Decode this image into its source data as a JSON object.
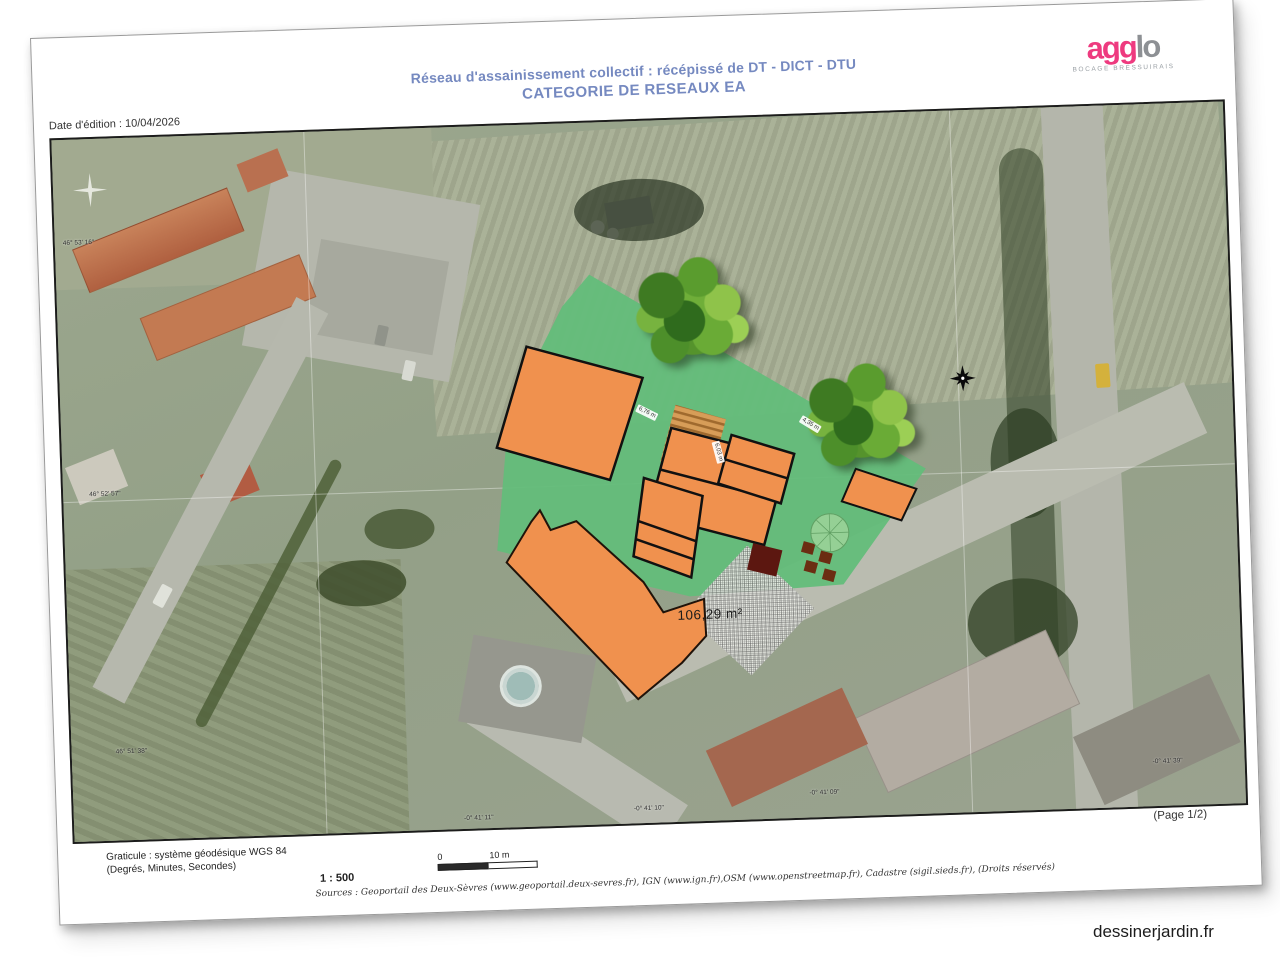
{
  "document": {
    "title_line1": "Réseau d'assainissement collectif : récépissé de DT - DICT - DTU",
    "title_line2": "CATEGORIE DE RESEAUX EA",
    "edition_date": "Date d'édition : 10/04/2026",
    "page_label": "(Page 1/2)"
  },
  "logo": {
    "text_pink": "agg",
    "text_gray": "lo",
    "subtitle": "BOCAGE BRESSUIRAIS"
  },
  "map": {
    "area_label": "106,29 m²",
    "dimension_labels": [
      {
        "text": "6,76 m"
      },
      {
        "text": "6,03 m"
      },
      {
        "text": "4,35 m"
      }
    ],
    "coordinate_labels": [
      {
        "text": "46° 53' 16\""
      },
      {
        "text": "46° 52' 57\""
      },
      {
        "text": "46° 51' 38\""
      },
      {
        "text": "-0° 41' 11\""
      },
      {
        "text": "-0° 41' 10\""
      },
      {
        "text": "-0° 41' 09\""
      },
      {
        "text": "-0° 41' 39\""
      }
    ]
  },
  "footer": {
    "graticule_line1": "Graticule : système géodésique WGS 84",
    "graticule_line2": "(Degrés, Minutes, Secondes)",
    "scale_ratio": "1 : 500",
    "scale_start": "0",
    "scale_end": "10 m",
    "sources": "Sources : Geoportail des Deux-Sèvres (www.geoportail.deux-sevres.fr), IGN (www.ign.fr),OSM (www.openstreetmap.fr), Cadastre (sigil.sieds.fr), (Droits réservés)"
  },
  "watermark": "dessinerjardin.fr",
  "colors": {
    "title_blue": "#7589c0",
    "logo_pink": "#ee3a7f",
    "overlay_green": "#63bd7a",
    "building_orange": "#f0914e",
    "hatch_area": "#eef0ea"
  }
}
